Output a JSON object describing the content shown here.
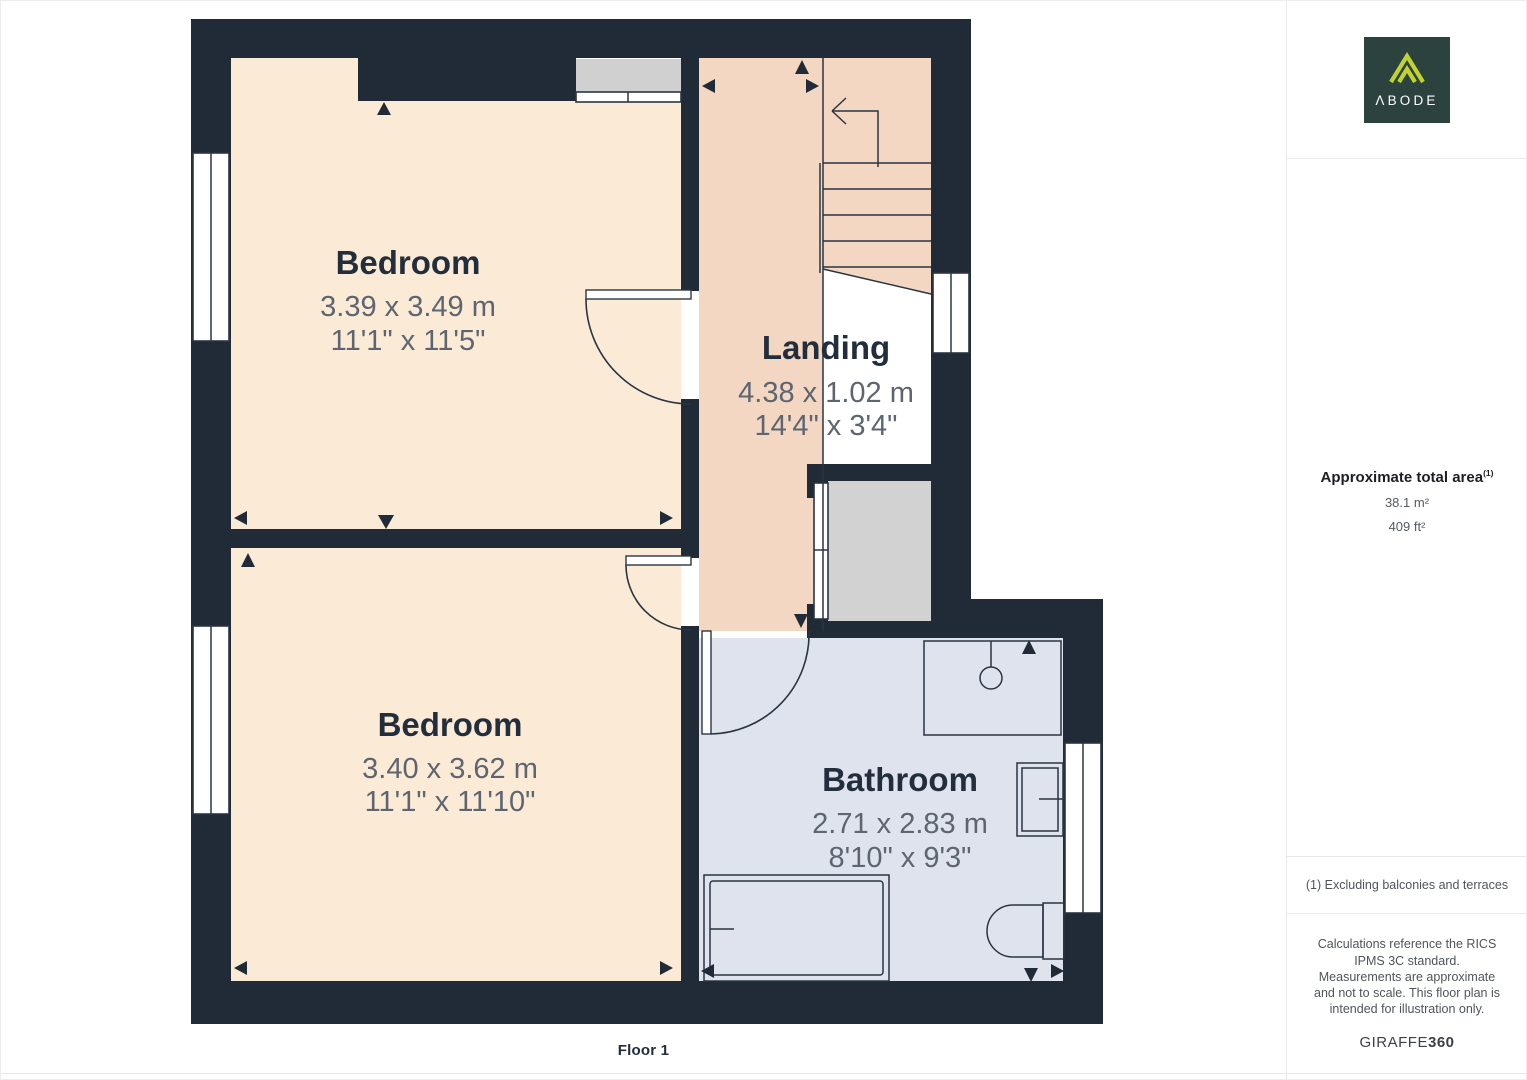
{
  "page": {
    "floor_label": "Floor 1"
  },
  "floor_plan": {
    "rooms": [
      {
        "id": "bedroom-1",
        "name": "Bedroom",
        "dim_m": "3.39 x 3.49 m",
        "dim_ft": "11'1\" x 11'5\"",
        "color": "#fbead6"
      },
      {
        "id": "bedroom-2",
        "name": "Bedroom",
        "dim_m": "3.40 x 3.62 m",
        "dim_ft": "11'1\" x 11'10\"",
        "color": "#fbead6"
      },
      {
        "id": "landing",
        "name": "Landing",
        "dim_m": "4.38 x 1.02 m",
        "dim_ft": "14'4\" x 3'4\"",
        "color": "#f4d7c2"
      },
      {
        "id": "bathroom",
        "name": "Bathroom",
        "dim_m": "2.71 x 2.83 m",
        "dim_ft": "8'10\" x 9'3\"",
        "color": "#dfe3ee"
      }
    ],
    "colors": {
      "wall": "#202b37",
      "line": "#2a3542",
      "room_label": "#232e3c",
      "dimension_text": "#5d6570",
      "cupboard_fill": "#d2d2d2",
      "window_alcove_fill": "#d0d0d0",
      "divider": "#e9e9e9"
    }
  },
  "sidebar": {
    "logo_text": "ΛBODE",
    "logo_colors": {
      "background": "#2c423f",
      "accent": "#c1d32f",
      "text": "#ffffff"
    },
    "area": {
      "title": "Approximate total area",
      "footnote_marker": "(1)",
      "value_metric": "38.1 m²",
      "value_imperial": "409 ft²"
    },
    "footnote": "(1) Excluding balconies and terraces",
    "disclaimer": "Calculations reference the RICS IPMS 3C standard. Measurements are approximate and not to scale. This floor plan is intended for illustration only.",
    "brand": {
      "name": "GIRAFFE",
      "suffix": "360"
    }
  }
}
